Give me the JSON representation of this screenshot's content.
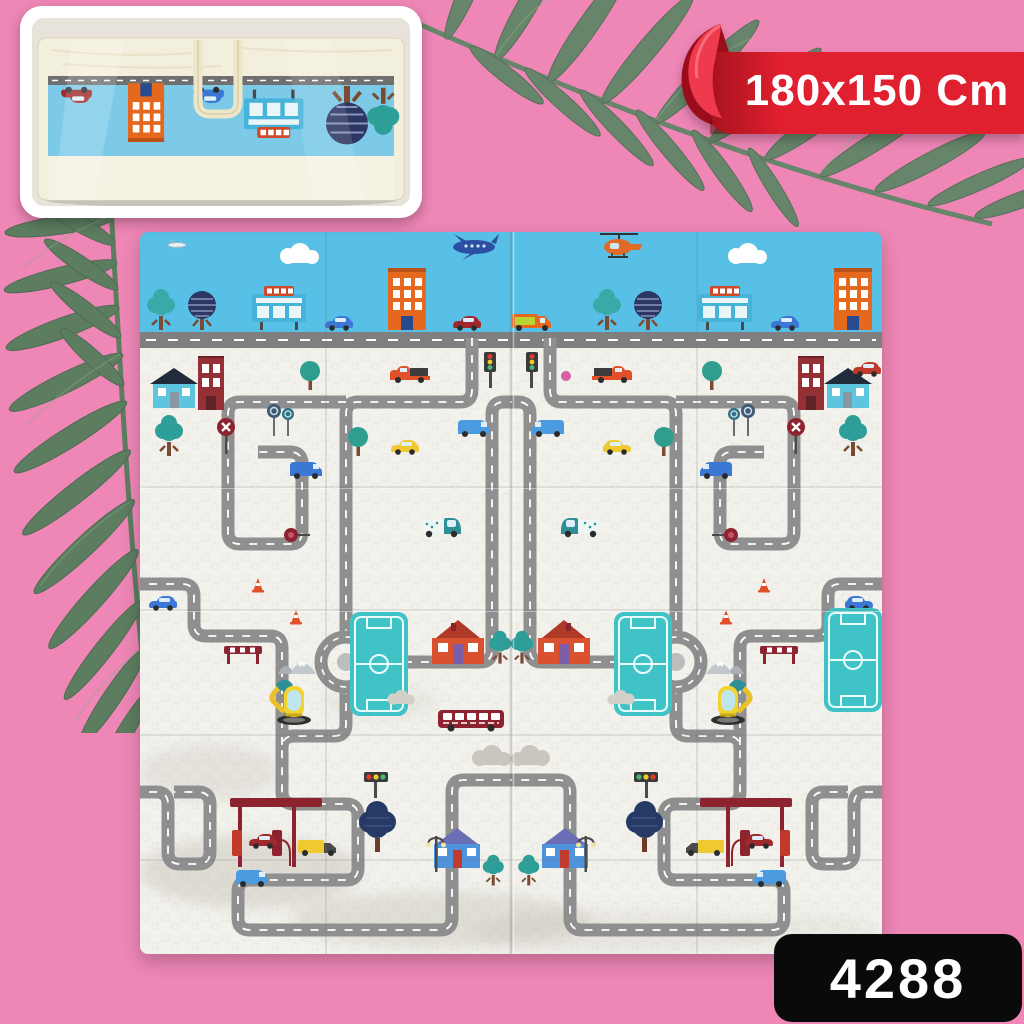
{
  "background": {
    "color": "#ee86b6"
  },
  "banner": {
    "label": "180x150 Cm",
    "band_color": "#e1202f",
    "curl_color": "#9c0d1c",
    "text_color": "#ffffff"
  },
  "badge": {
    "label": "4288",
    "bg_color": "#0a0a0a",
    "text_color": "#ffffff"
  },
  "inset_preview": {
    "items": [
      "carry-bag",
      "carry-handle",
      "folded-playmat-print",
      "upside-down-city-motifs"
    ]
  },
  "decor": {
    "leaf_color": "#5c7d60",
    "leaves": [
      "fern-leaf-left",
      "fern-leaf-top"
    ]
  },
  "playmat": {
    "sky_color": "#58c0e6",
    "mat_color": "#f2f1ec",
    "road_color": "#8f8f8f",
    "teal_accent": "#3fc3c7",
    "sky_items": [
      "small-plane",
      "cloud",
      "airplane",
      "helicopter",
      "orange-van",
      "teal-tree",
      "striped-navy-tree",
      "billboard",
      "blue-car",
      "orange-building",
      "red-car"
    ],
    "ground_items": [
      "road-network",
      "roundabout",
      "soccer-field",
      "blue-house",
      "brick-building",
      "red-house",
      "blue-cottage",
      "pickup-truck",
      "traffic-light",
      "stop-sign",
      "yellow-car",
      "blue-van",
      "teal-truck",
      "traffic-cones",
      "dark-red-bus",
      "excavator",
      "gas-station",
      "yellow-truck",
      "navy-tree",
      "street-lamp",
      "barrier",
      "mountains",
      "gray-clouds",
      "pink-ball"
    ]
  }
}
